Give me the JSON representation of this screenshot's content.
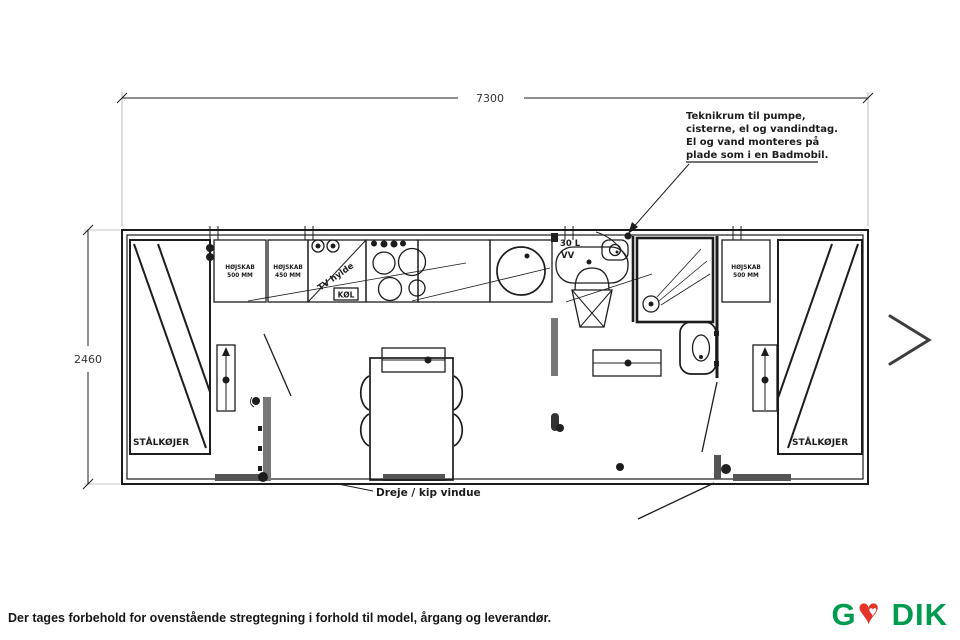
{
  "page": {
    "disclaimer": "Der tages forbehold for ovenstående stregtegning i forhold til model, årgang og leverandør."
  },
  "logo": {
    "prefix": "G",
    "suffix": "DIK",
    "green": "#009b4e",
    "heart_red": "#e53328"
  },
  "plan": {
    "dim_width": "7300",
    "dim_height": "2460",
    "annotation": {
      "line1": "Teknikrum til pumpe,",
      "line2": "cisterne, el og vandindtag.",
      "line3": "El og vand monteres på",
      "line4": "plade som i en Badmobil."
    },
    "labels": {
      "bunk_left": "STÅLKØJER",
      "bunk_right": "STÅLKØJER",
      "cab1_name": "HØJSKAB",
      "cab1_size": "500 MM",
      "cab2_name": "HØJSKAB",
      "cab2_size": "450 MM",
      "cab3_name": "HØJSKAB",
      "cab3_size": "500 MM",
      "tv": "TV hylde",
      "fridge": "KØL",
      "boiler1": "30 L",
      "boiler2": "VV",
      "window": "Dreje / kip vindue"
    }
  }
}
